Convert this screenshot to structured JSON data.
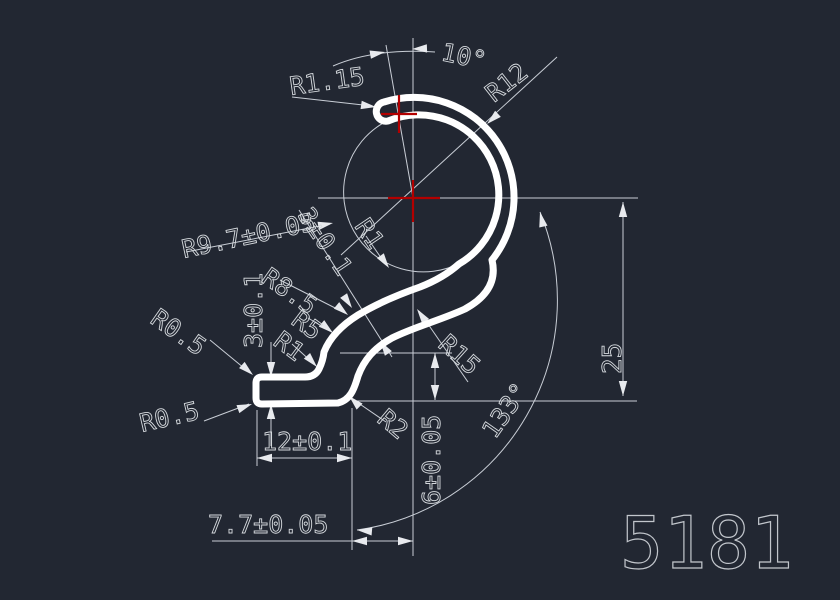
{
  "drawing": {
    "part_number": "5181",
    "type": "extrusion-profile-section",
    "colors": {
      "background": "#222732",
      "profile_stroke": "#ffffff",
      "dimension_stroke": "#c9ced6",
      "text_stroke": "#d6dade",
      "highlight_red": "#b30000"
    },
    "labels": {
      "r115": "R1.15",
      "angle10": "10°",
      "r12": "R12",
      "r97": "R9.7±0.05",
      "wall3": "3±0.1",
      "r85": "R8.5",
      "r5": "R5",
      "r1_wall": "R1",
      "r1_ring": "R1",
      "r05_top": "R0.5",
      "r05_bottom": "R0.5",
      "foot3": "3±0.1",
      "r15": "R15",
      "r2": "R2",
      "dim12": "12±0.1",
      "dim77": "7.7±0.05",
      "dim6": "6±0.05",
      "dim25": "25",
      "angle133": "133°",
      "part": "5181"
    }
  }
}
